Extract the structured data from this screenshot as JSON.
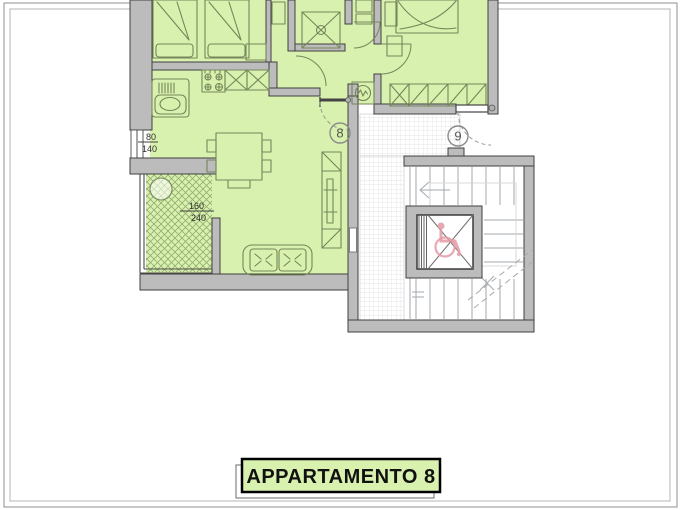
{
  "title_box": {
    "label": "APPARTAMENTO 8"
  },
  "plan": {
    "unit_markers": [
      {
        "label": "8"
      },
      {
        "label": "9"
      }
    ],
    "dimensions": [
      {
        "numerator": "80",
        "denominator": "140"
      },
      {
        "numerator": "160",
        "denominator": "240"
      }
    ]
  },
  "colors": {
    "room_fill": "#d9f1ae",
    "hatch_line": "#93ad72",
    "wall_fill": "#bcbcbc",
    "wall_outline": "#3f3f3f",
    "furniture_line": "#75865a",
    "stair_line": "#a3a9ae",
    "stair_guide": "#d2d6da",
    "grid_line": "#dedede",
    "dash_line": "#a8a8a8",
    "accessibility_pink": "#e49aa6",
    "frame_outer": "#8f8f8f",
    "frame_inner": "#b4b4b4",
    "text_color": "#2e2e2e",
    "title_text": "#111111"
  }
}
